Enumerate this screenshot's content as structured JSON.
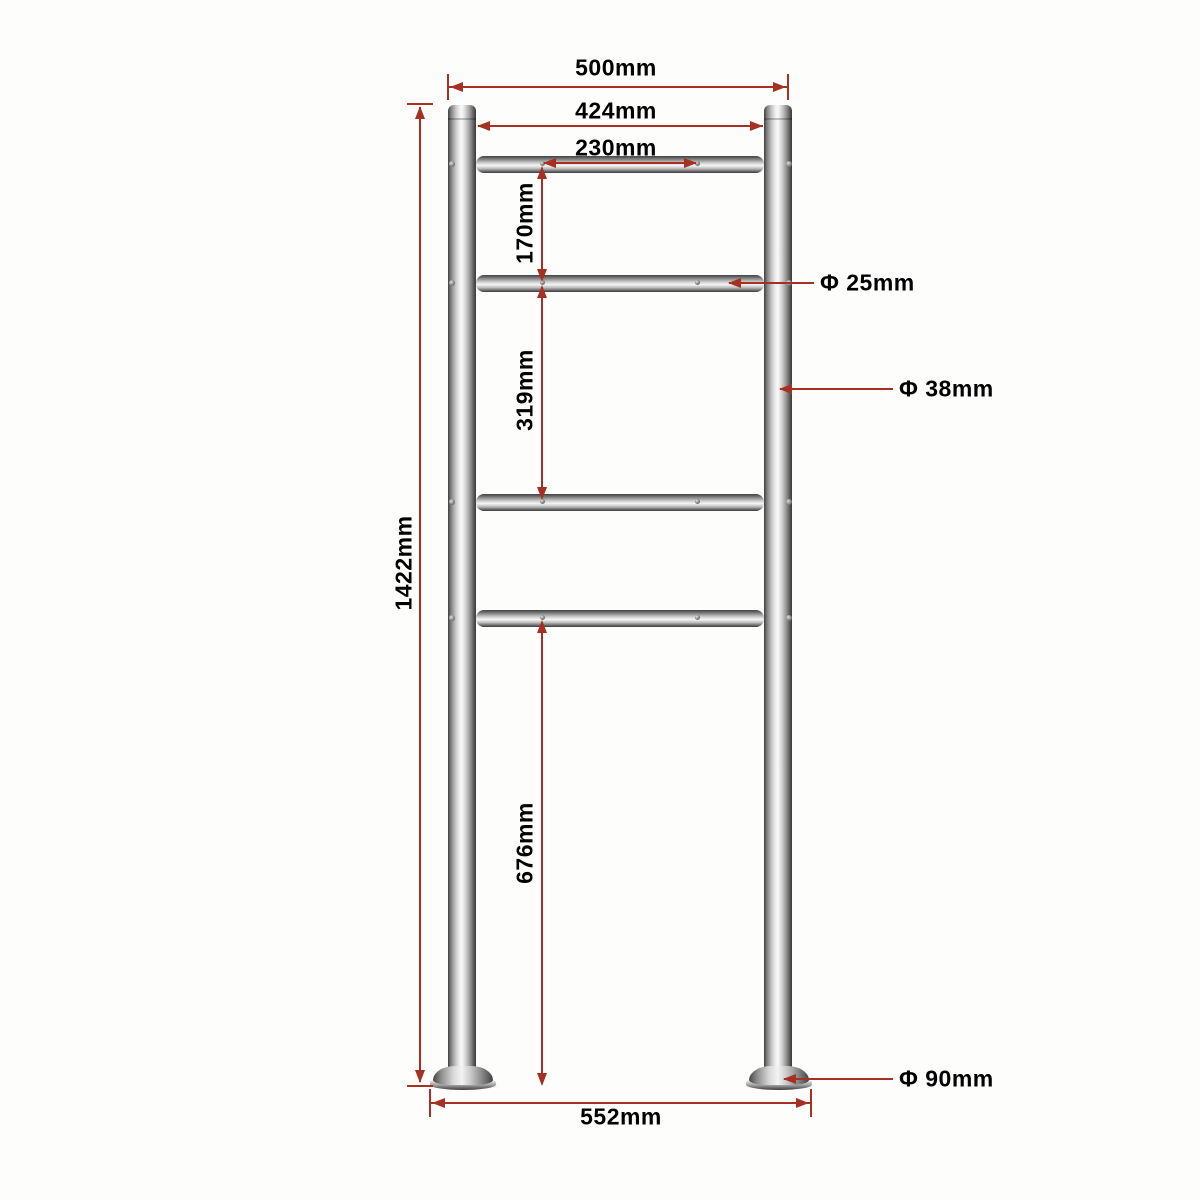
{
  "diagram": {
    "kind": "technical-dimension-drawing",
    "subject": "stainless-steel mailbox stand frame (two posts, four crossbars, round base plates)",
    "colors": {
      "background": "#fdfdfc",
      "dimension_lines": "#a63122",
      "label_text": "#000000",
      "metal_light": "#f6f6f6",
      "metal_dark": "#3e3e3e"
    },
    "labels": {
      "top_width": "500mm",
      "inner_width": "424mm",
      "hole_spacing": "230mm",
      "upper_gap": "170mm",
      "middle_gap": "319mm",
      "lower_height": "676mm",
      "total_height": "1422mm",
      "base_span": "552mm",
      "crossbar_diameter": "Φ 25mm",
      "post_diameter": "Φ 38mm",
      "base_plate_diameter": "Φ 90mm"
    }
  }
}
